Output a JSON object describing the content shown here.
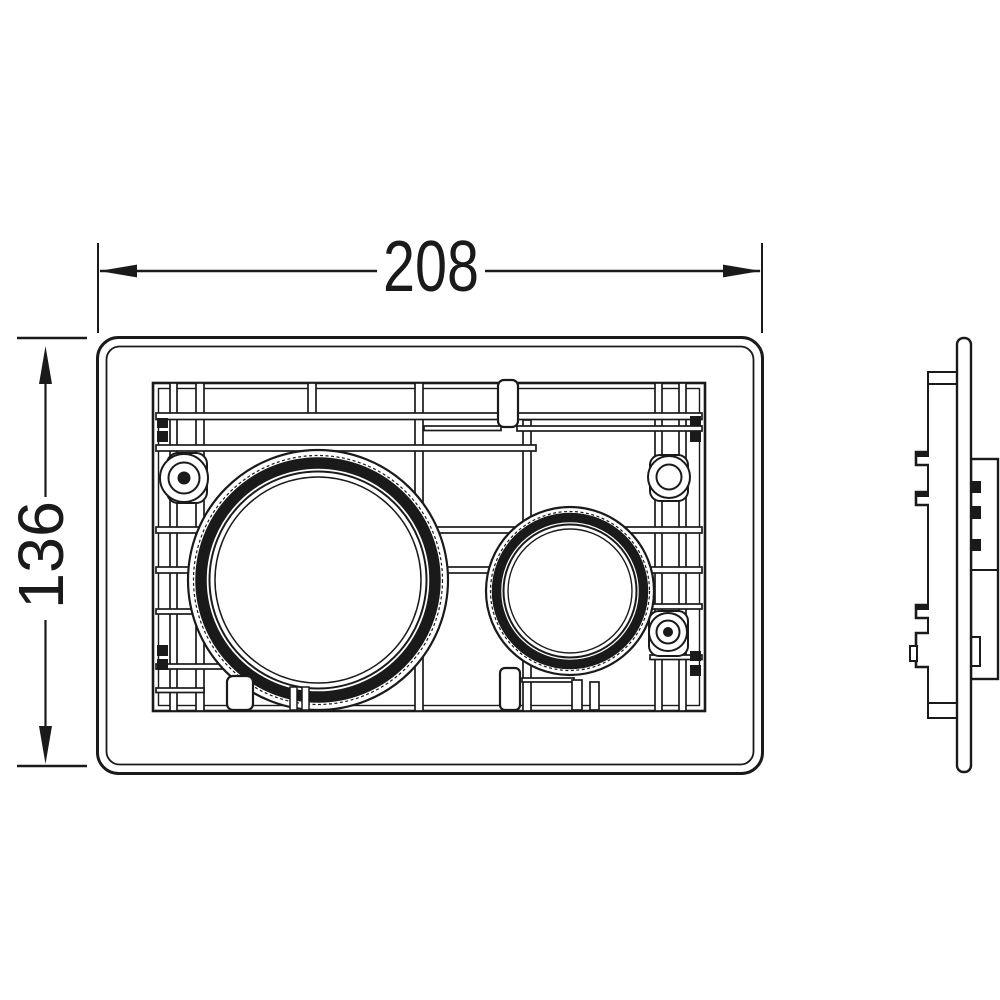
{
  "drawing": {
    "type": "dimensioned technical drawing",
    "subject": "flush plate, front elevation and side elevation",
    "dimensions": {
      "width": {
        "value": "208"
      },
      "height": {
        "value": "136"
      }
    },
    "colors": {
      "line": "#1a1a1a",
      "background": "#ffffff"
    }
  }
}
